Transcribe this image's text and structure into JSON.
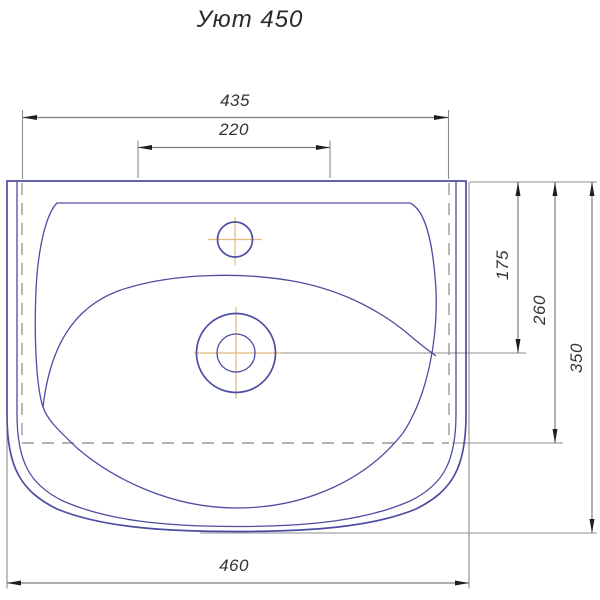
{
  "title": "Уют 450",
  "drawing": {
    "subject_label": "washbasin-top-view-technical-drawing",
    "dimensions": {
      "rear_width": "435",
      "center_span": "220",
      "overall_width": "460",
      "drain_center_depth": "175",
      "rear_ledge_depth": "260",
      "overall_depth": "350"
    },
    "colors": {
      "outline_blue": "#4d4da2",
      "dimension_gray": "#7d7d7d",
      "extension_gray": "#8d8d8d",
      "hidden_line_gray": "#999999",
      "arrow_black": "#1f1f1f",
      "centerline_orange": "#dfb97e",
      "text": "#333333",
      "background": "#ffffff"
    }
  }
}
